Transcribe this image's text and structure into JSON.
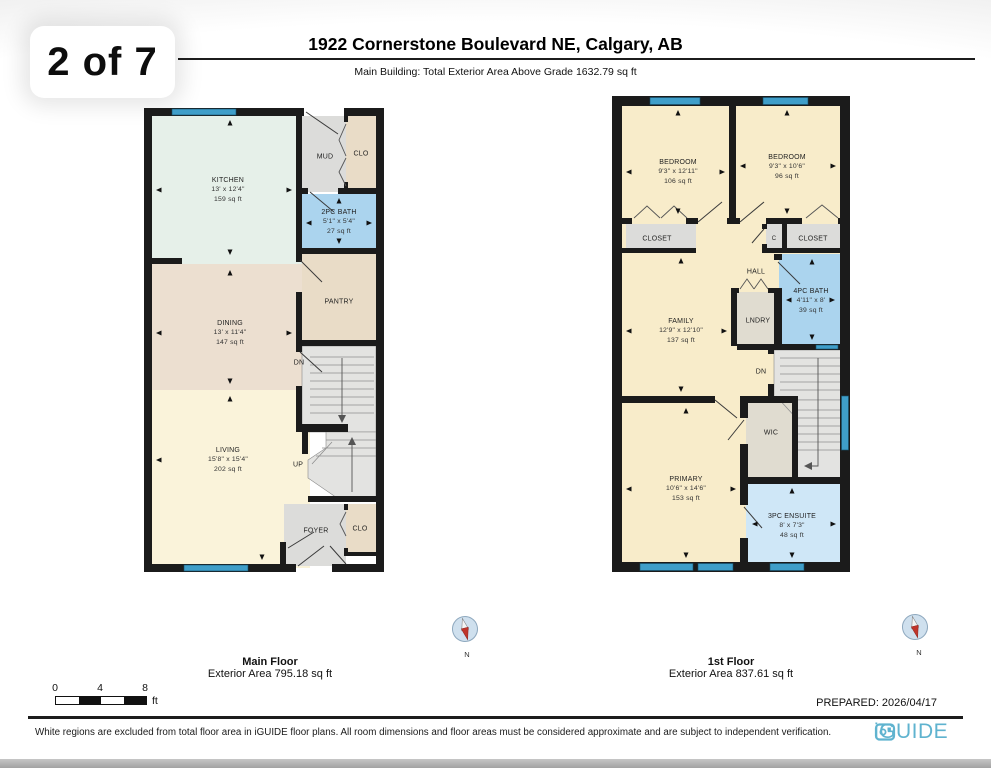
{
  "page": {
    "page_indicator": "2 of 7",
    "title": "1922 Cornerstone Boulevard NE, Calgary, AB",
    "subtitle": "Main Building: Total Exterior Area Above Grade 1632.79 sq ft",
    "prepared": "PREPARED: 2026/04/17",
    "disclaimer": "White regions are excluded from total floor area in iGUIDE floor plans. All room dimensions and floor areas must be considered approximate and are subject to independent verification.",
    "brand": "iGUIDE"
  },
  "scale_bar": {
    "tick0": "0",
    "tick1": "4",
    "tick2": "8",
    "unit": "ft"
  },
  "compass": {
    "label": "N"
  },
  "floors": [
    {
      "name": "Main Floor",
      "area_label": "Exterior Area 795.18 sq ft",
      "rooms": {
        "kitchen": {
          "label": "KITCHEN",
          "dims": "13' x 12'4\"",
          "area": "159 sq ft"
        },
        "mud": {
          "label": "MUD"
        },
        "clo_top": {
          "label": "CLO"
        },
        "bath_2pc": {
          "label": "2PC BATH",
          "dims": "5'1\" x 5'4\"",
          "area": "27 sq ft"
        },
        "dining": {
          "label": "DINING",
          "dims": "13' x 11'4\"",
          "area": "147 sq ft"
        },
        "pantry": {
          "label": "PANTRY"
        },
        "stairs_dn": {
          "label": "DN"
        },
        "living": {
          "label": "LIVING",
          "dims": "15'8\" x 15'4\"",
          "area": "202 sq ft"
        },
        "stairs_up": {
          "label": "UP"
        },
        "foyer": {
          "label": "FOYER"
        },
        "clo_bottom": {
          "label": "CLO"
        }
      }
    },
    {
      "name": "1st Floor",
      "area_label": "Exterior Area 837.61 sq ft",
      "rooms": {
        "bedroom_left": {
          "label": "BEDROOM",
          "dims": "9'3\" x 12'11\"",
          "area": "106 sq ft"
        },
        "bedroom_right": {
          "label": "BEDROOM",
          "dims": "9'3\" x 10'6\"",
          "area": "96 sq ft"
        },
        "closet_left": {
          "label": "CLOSET"
        },
        "closet_small": {
          "label": "C"
        },
        "closet_right": {
          "label": "CLOSET"
        },
        "hall": {
          "label": "HALL"
        },
        "family": {
          "label": "FAMILY",
          "dims": "12'9\" x 12'10\"",
          "area": "137 sq ft"
        },
        "laundry": {
          "label": "LNDRY"
        },
        "bath_4pc": {
          "label": "4PC BATH",
          "dims": "4'11\" x 8'",
          "area": "39 sq ft"
        },
        "stairs_dn": {
          "label": "DN"
        },
        "wic": {
          "label": "WIC"
        },
        "primary": {
          "label": "PRIMARY",
          "dims": "10'6\" x 14'6\"",
          "area": "153 sq ft"
        },
        "ensuite": {
          "label": "3PC ENSUITE",
          "dims": "8' x 7'3\"",
          "area": "48 sq ft"
        }
      }
    }
  ],
  "colors": {
    "wall": "#1b1b1b",
    "window_blue": "#3f9ec9",
    "bath_blue": "#abd4ee",
    "ensuite_blue": "#cfe7f7",
    "bedroom_cream": "#f8ecca",
    "kitchen_mint": "#e6f0e9",
    "dining_tan": "#ecdfd0",
    "living_cream": "#faf3da",
    "utility_gray": "#dcdcda",
    "closet_tan": "#e9dcc7",
    "brand_blue": "#5fb3cf"
  }
}
